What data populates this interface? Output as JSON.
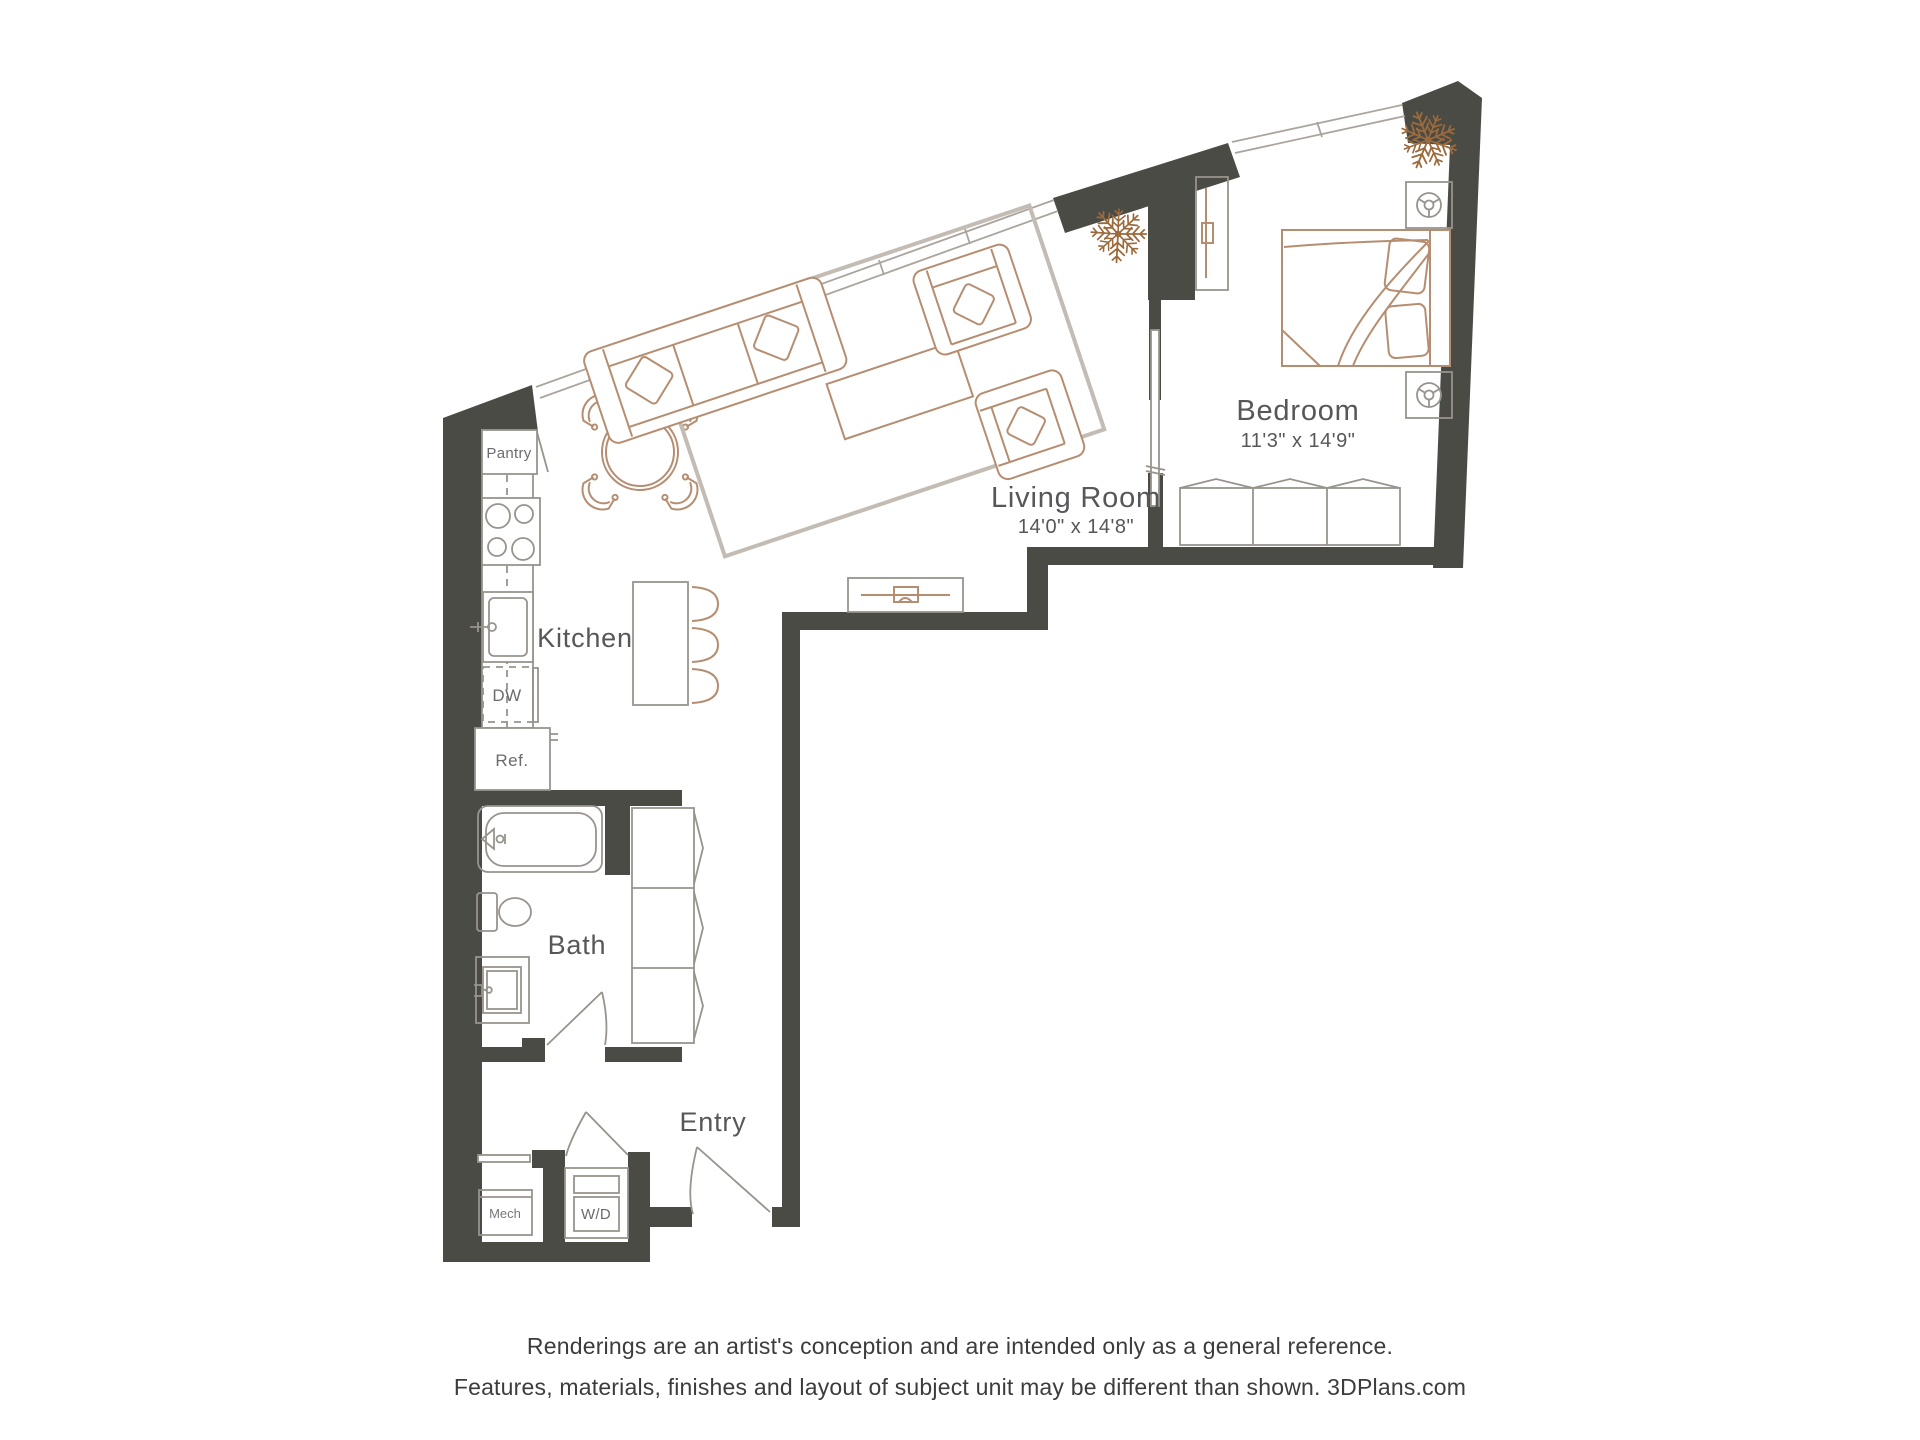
{
  "plan": {
    "rooms": {
      "bedroom": {
        "label": "Bedroom",
        "dims": "11'3\" x 14'9\""
      },
      "living": {
        "label": "Living Room",
        "dims": "14'0\" x 14'8\""
      },
      "kitchen": {
        "label": "Kitchen"
      },
      "bath": {
        "label": "Bath"
      },
      "entry": {
        "label": "Entry"
      }
    },
    "fixtures": {
      "pantry": "Pantry",
      "dishwasher": "DW",
      "refrigerator": "Ref.",
      "mechanical": "Mech",
      "washer_dryer": "W/D"
    }
  },
  "disclaimer": {
    "line1": "Renderings are an artist's conception and are intended only as a general reference.",
    "line2": "Features, materials, finishes and layout of subject unit may be different than shown. 3DPlans.com"
  },
  "colors": {
    "wall": "#4b4b46",
    "fixture_line": "#98938c",
    "furniture_line": "#b58e71",
    "window_line": "#aaa49d",
    "label_text": "#57575a",
    "plant": "#9c6a3c"
  }
}
